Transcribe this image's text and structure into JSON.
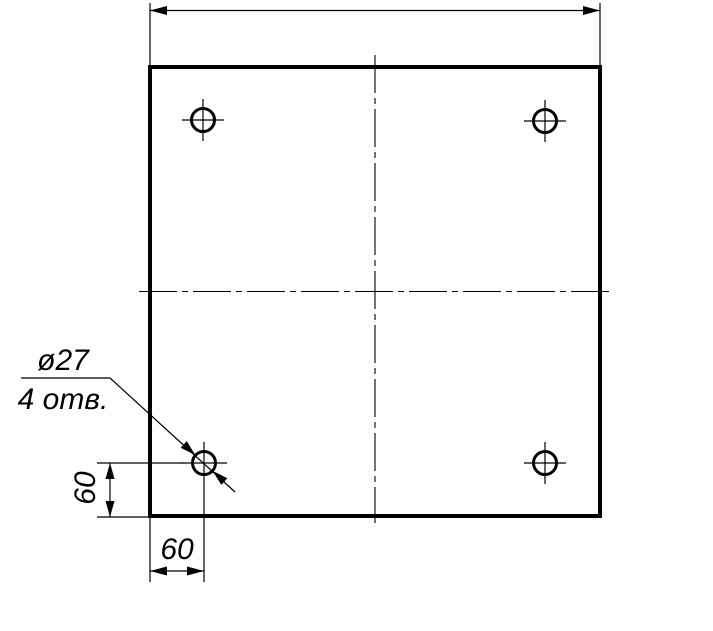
{
  "drawing": {
    "kind": "technical-drawing",
    "subject": "square plate with four drilled holes",
    "background_color": "#ffffff",
    "line_color": "#000000",
    "hole_callout": {
      "diameter_label": "ø27",
      "count_label": "4 отв."
    },
    "dimensions": {
      "hole_offset_left": "60",
      "hole_offset_bottom": "60"
    }
  }
}
